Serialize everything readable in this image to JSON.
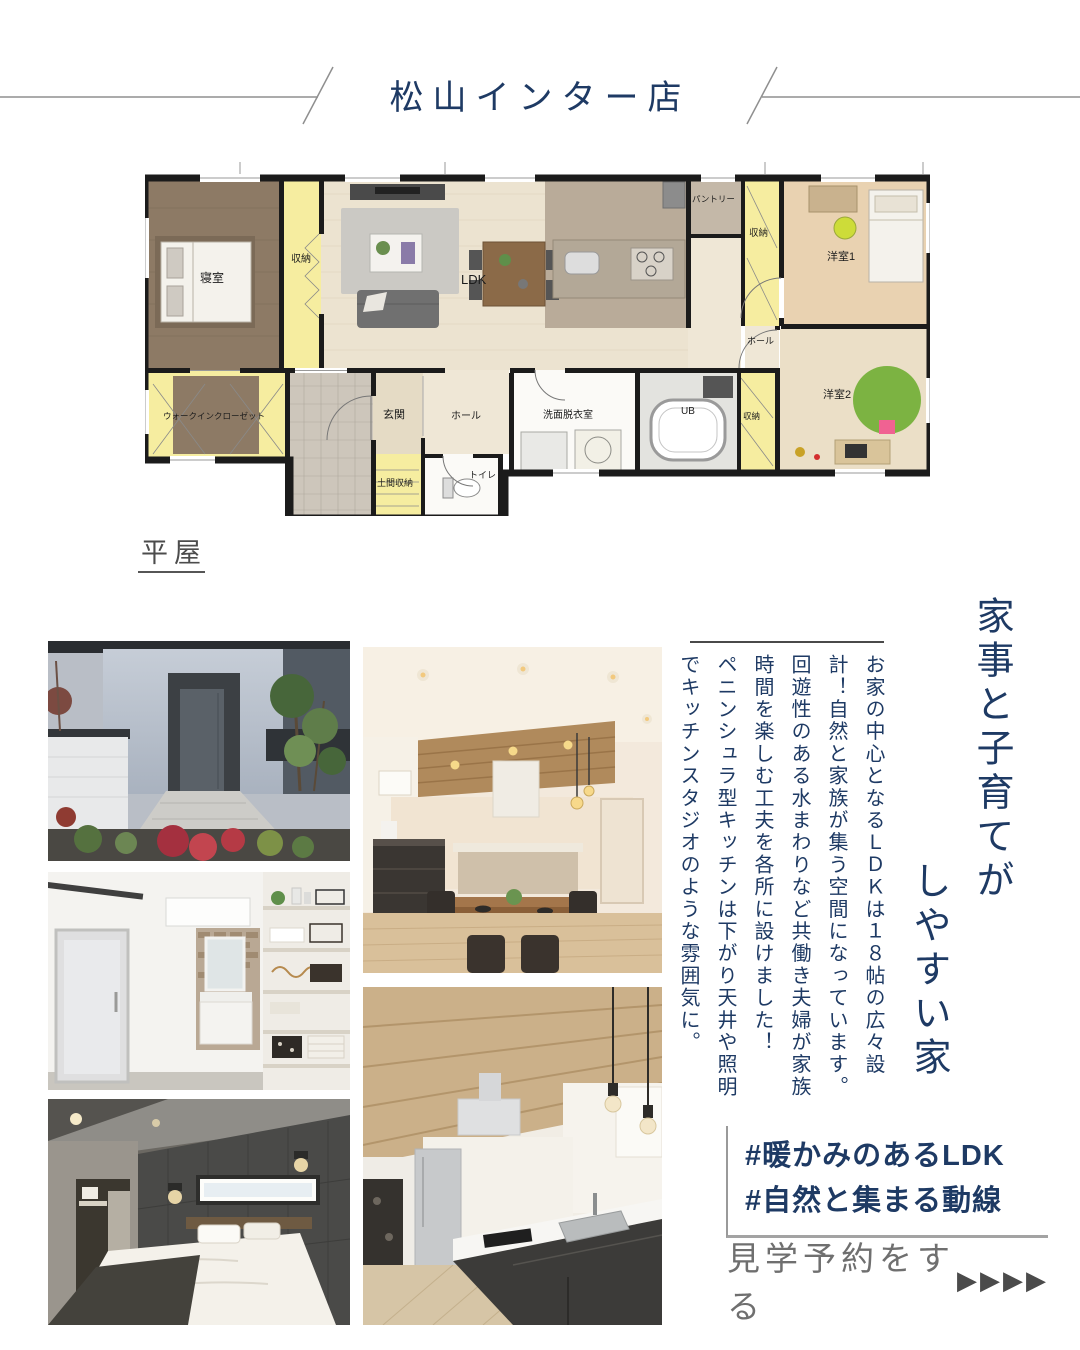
{
  "header": {
    "store_name": "松山インター店"
  },
  "floorplan": {
    "type_label": "平屋",
    "rooms": [
      {
        "label": "寝室"
      },
      {
        "label": "収納"
      },
      {
        "label": "LDK"
      },
      {
        "label": "パントリー"
      },
      {
        "label": "収納"
      },
      {
        "label": "洋室1"
      },
      {
        "label": "ホール"
      },
      {
        "label": "ウォークインクローゼット"
      },
      {
        "label": "玄関"
      },
      {
        "label": "ホール"
      },
      {
        "label": "土間収納"
      },
      {
        "label": "トイレ"
      },
      {
        "label": "洗面脱衣室"
      },
      {
        "label": "UB"
      },
      {
        "label": "収納"
      },
      {
        "label": "洋室2"
      }
    ]
  },
  "headline": {
    "line1": "家事と子育てが",
    "line2": "しやすい家"
  },
  "body_text": {
    "columns": [
      "お家の中心となるＬＤＫは１８帖の広々設",
      "計！自然と家族が集う空間になっています。",
      "回遊性のある水まわりなど共働き夫婦が家族",
      "時間を楽しむ工夫を各所に設けました！",
      "ペニンシュラ型キッチンは下がり天井や照明",
      "でキッチンスタジオのような雰囲気に。"
    ]
  },
  "hashtags": {
    "tag1": "#暖かみのあるLDK",
    "tag2": "#自然と集まる動線"
  },
  "cta": {
    "label": "見学予約をする",
    "arrows": "▶▶▶▶"
  },
  "photos": [
    {
      "name": "exterior-approach-photo"
    },
    {
      "name": "sanitary-room-photo"
    },
    {
      "name": "bedroom-photo"
    },
    {
      "name": "dining-kitchen-photo"
    },
    {
      "name": "kitchen-photo"
    }
  ],
  "colors": {
    "accent_navy": "#1e3a64",
    "deco_line_gray": "#8f8f8f",
    "cta_text_gray": "#6f6f6f",
    "arrow_gray": "#4b4b4b"
  }
}
